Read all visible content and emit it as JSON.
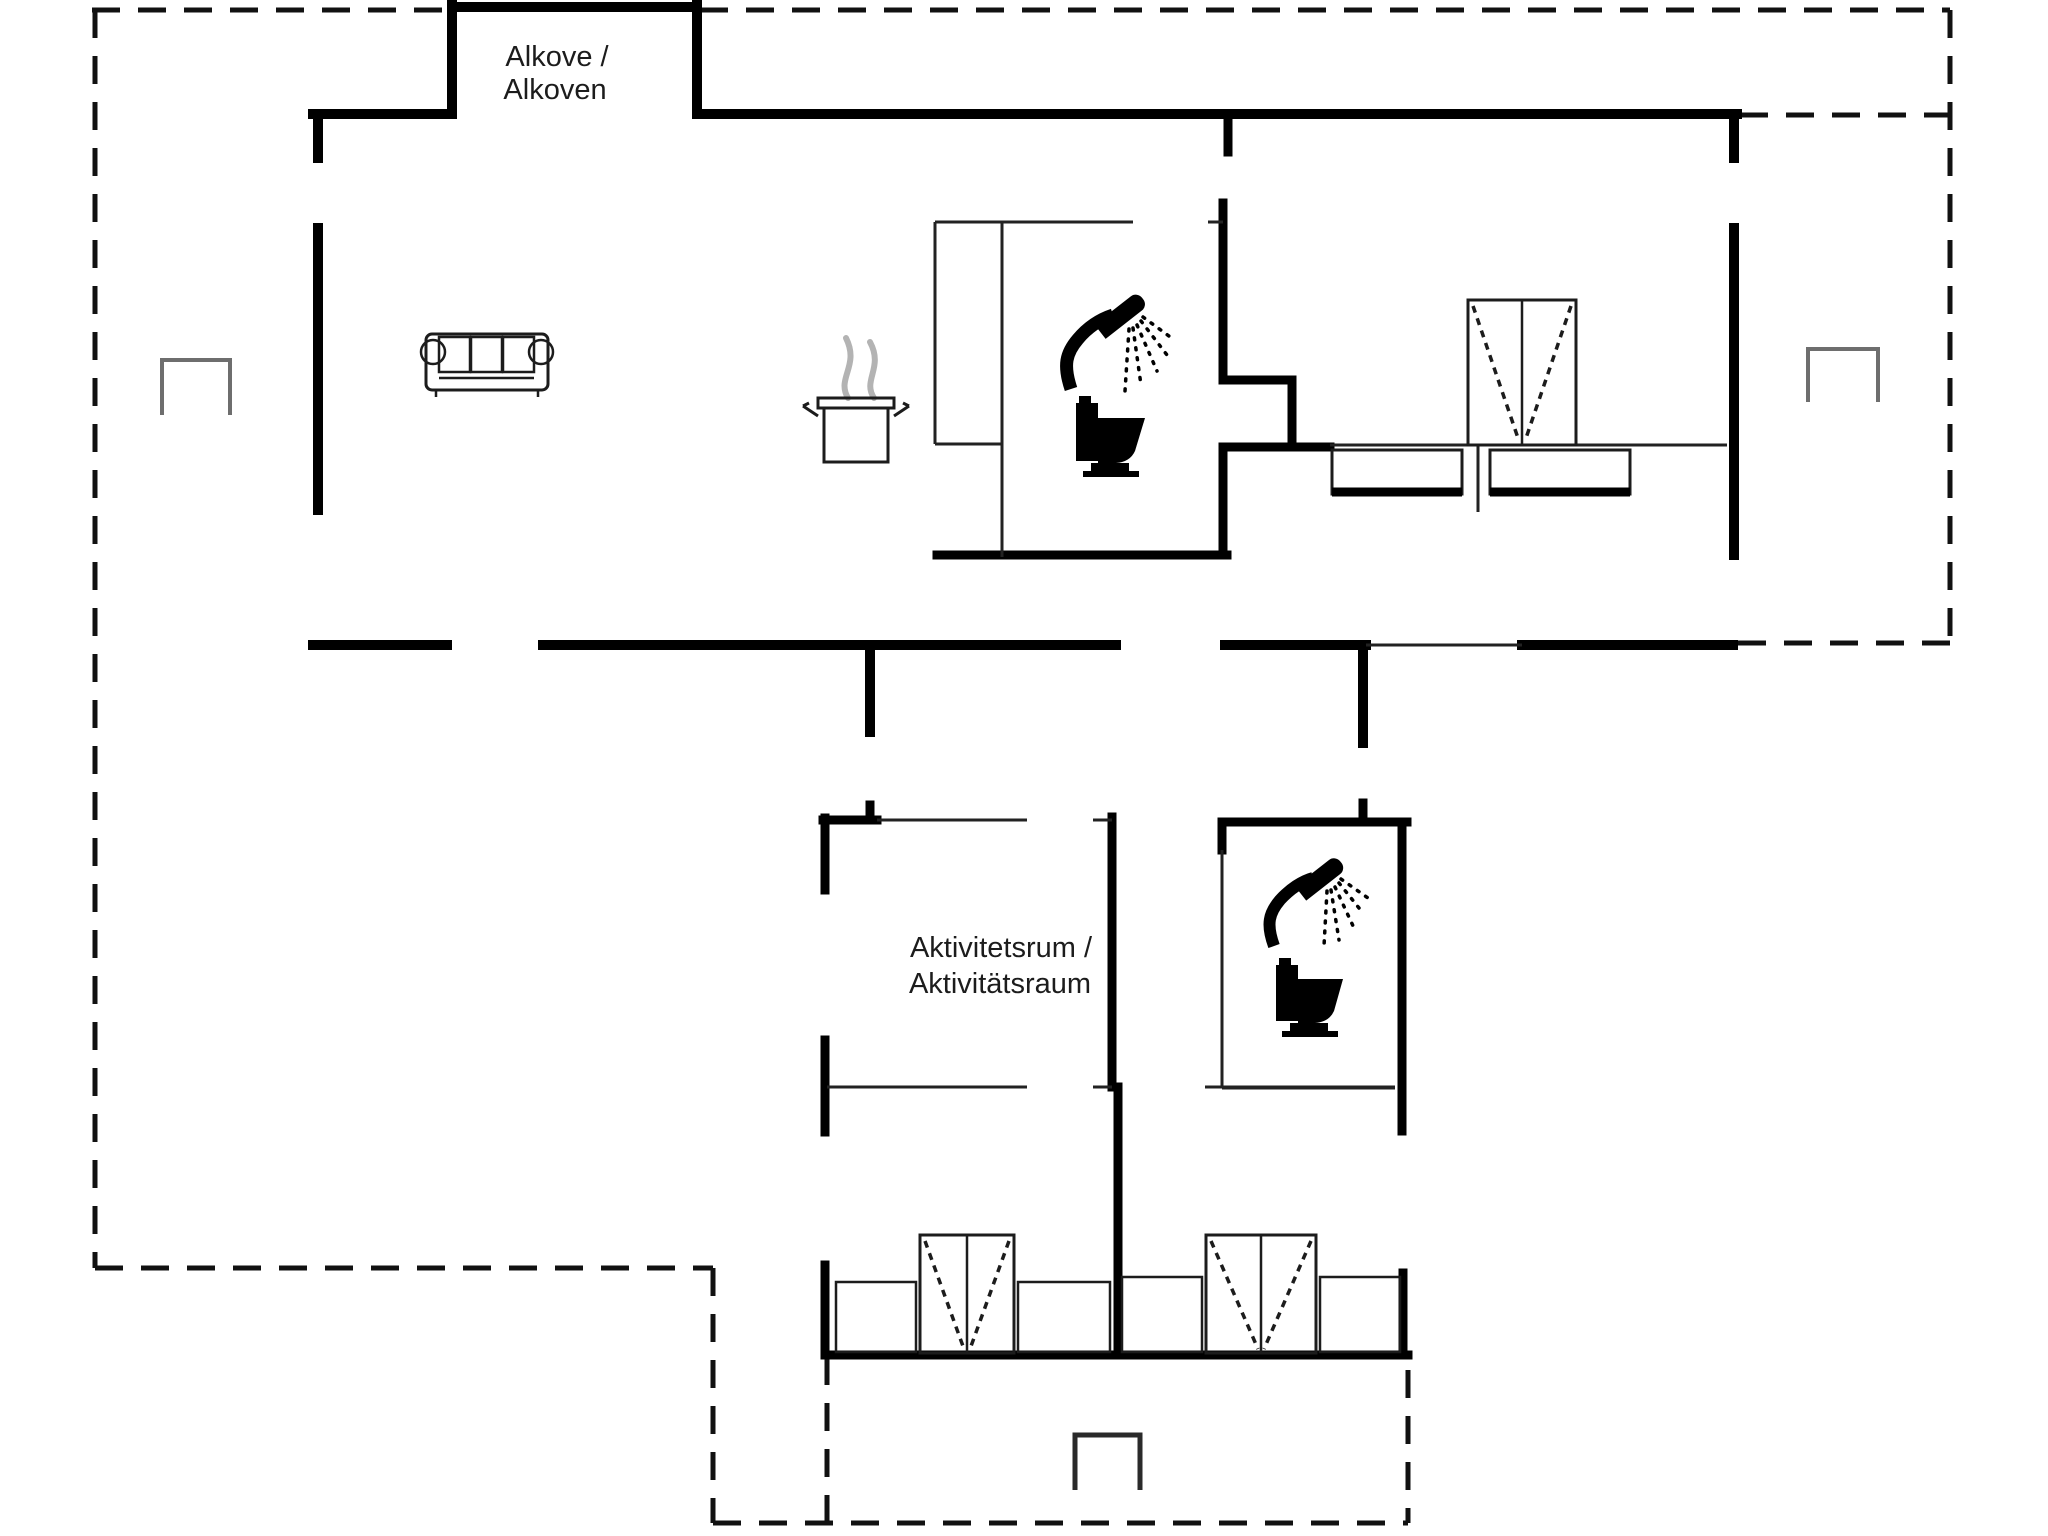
{
  "document": {
    "type": "floor-plan",
    "background": "#ffffff"
  },
  "floorplan": {
    "labels": {
      "alcove": {
        "line1": "Alkove /",
        "line2": "Alkoven"
      },
      "activity_room": {
        "line1": "Aktivitetsrum /",
        "line2": "Aktivitätsraum"
      }
    },
    "colors": {
      "wall": "#000000",
      "thin_line": "#222222",
      "dashed_boundary": "#111111",
      "steam_gray": "#b3b3b3",
      "marker_gray": "#6e6e6e",
      "text": "#1c1c1c",
      "background": "#ffffff"
    },
    "icons": [
      {
        "name": "sofa-icon"
      },
      {
        "name": "cooking-pot-icon"
      },
      {
        "name": "shower-icon"
      },
      {
        "name": "toilet-icon"
      },
      {
        "name": "wardrobe-icon"
      },
      {
        "name": "bed-icon"
      },
      {
        "name": "terrace-marker-icon"
      }
    ]
  }
}
